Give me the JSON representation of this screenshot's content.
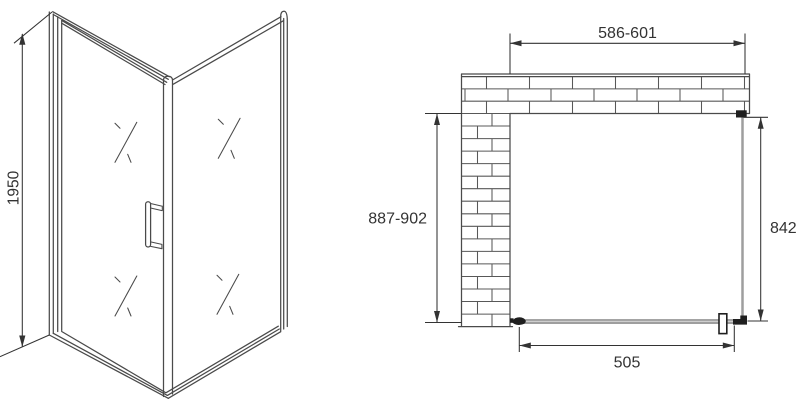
{
  "drawing": {
    "perspective_view": {
      "height_dimension": "1950"
    },
    "plan_view": {
      "top_width_dimension": "586-601",
      "side_depth_dimension": "887-902",
      "panel_depth_dimension": "842",
      "door_width_dimension": "505"
    }
  },
  "colors": {
    "line": "#4a4a4a",
    "brick": "#585858",
    "dimension": "#333333",
    "glass": "#9e9e9e",
    "fitting": "#1f1f1f",
    "background": "#ffffff"
  }
}
